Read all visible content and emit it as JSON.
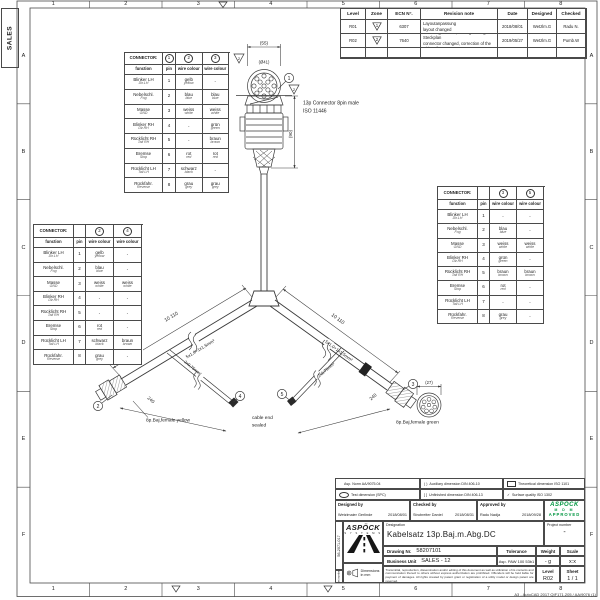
{
  "colors": {
    "line": "#3a3a3a",
    "approved_green": "#009640"
  },
  "frame": {
    "sales_stamp": "SALES",
    "top_zones": [
      "1",
      "2",
      "3",
      "4",
      "5",
      "6",
      "7",
      "8"
    ],
    "bottom_zones": [
      "1",
      "2",
      "3",
      "4",
      "5",
      "6",
      "7",
      "8"
    ],
    "left_zones": [
      "A",
      "B",
      "C",
      "D",
      "E",
      "F"
    ],
    "right_zones": [
      "A",
      "B",
      "C",
      "D",
      "E",
      "F"
    ],
    "corner_note": "A3 - AutoCAD 2017 QIF171.205 / AA/9076 (1)"
  },
  "revision_table": {
    "headers": {
      "level": "Level",
      "zone": "Zone",
      "ecn": "ECN N°.",
      "note": "Revision note",
      "date": "Date",
      "designed": "Designed",
      "checked": "Checked"
    },
    "rows": [
      {
        "level": "R01",
        "zone_flag": "1",
        "ecn": "6307",
        "note_de": "Layoutanpassung",
        "note_en": "layout changed",
        "date": "2018/08/01",
        "designed": "Wetzlm.G",
        "checked": "Radu N."
      },
      {
        "level": "R02",
        "zone_flag": "2",
        "ecn": "7640",
        "note_de": "Stecker geändert , Richtigstellung Steckplan",
        "note_en": "connector changed, correction of the wiring diagram",
        "date": "2019/05/27",
        "designed": "Wetzlm.G",
        "checked": "Pumb.W"
      }
    ]
  },
  "connector_tables": {
    "labels": {
      "title": "CONNECTOR:",
      "function": "function",
      "pin": "pin",
      "wire_colour": "wire colour"
    },
    "functions": [
      {
        "de": "Blinker LH",
        "en": "Dir.LH",
        "pin": "1"
      },
      {
        "de": "Nebelschl.",
        "en": "Fog",
        "pin": "2"
      },
      {
        "de": "Masse",
        "en": "GND",
        "pin": "3"
      },
      {
        "de": "Blinker RH",
        "en": "Dir.RH",
        "pin": "4"
      },
      {
        "de": "Rücklicht RH",
        "en": "Tail RH",
        "pin": "5"
      },
      {
        "de": "Bremse",
        "en": "Stop",
        "pin": "6"
      },
      {
        "de": "Rücklicht LH",
        "en": "Tail LH",
        "pin": "7"
      },
      {
        "de": "Rückfahr.",
        "en": "Reverse",
        "pin": "8"
      }
    ],
    "tables": [
      {
        "name": "connector-table-top-left",
        "pin_ref": "1",
        "refs": [
          "2",
          "3"
        ],
        "w1": [
          [
            "gelb",
            "yellow"
          ],
          [
            "blau",
            "blue"
          ],
          [
            "weiss",
            "white"
          ],
          null,
          null,
          [
            "rot",
            "red"
          ],
          [
            "schwarz",
            "black"
          ],
          [
            "grau",
            "grey"
          ]
        ],
        "w2": [
          null,
          [
            "blau",
            "blue"
          ],
          [
            "weiss",
            "white"
          ],
          [
            "grün",
            "green"
          ],
          [
            "braun",
            "brown"
          ],
          [
            "rot",
            "red"
          ],
          null,
          [
            "grau",
            "grey"
          ]
        ]
      },
      {
        "name": "connector-table-bottom-left",
        "pin_ref": "",
        "refs": [
          "2",
          "4"
        ],
        "w1": [
          [
            "gelb",
            "yellow"
          ],
          [
            "blau",
            "blue"
          ],
          [
            "weiss",
            "white"
          ],
          null,
          null,
          [
            "rot",
            "red"
          ],
          [
            "schwarz",
            "black"
          ],
          [
            "grau",
            "grey"
          ]
        ],
        "w2": [
          null,
          null,
          [
            "weiss",
            "white"
          ],
          null,
          null,
          null,
          [
            "braun",
            "brown"
          ],
          null
        ]
      },
      {
        "name": "connector-table-right",
        "pin_ref": "",
        "refs": [
          "3",
          "5"
        ],
        "w1": [
          null,
          [
            "blau",
            "blue"
          ],
          [
            "weiss",
            "white"
          ],
          [
            "grün",
            "green"
          ],
          [
            "braun",
            "brown"
          ],
          [
            "rot",
            "red"
          ],
          null,
          [
            "grau",
            "grey"
          ]
        ],
        "w2": [
          null,
          null,
          [
            "weiss",
            "white"
          ],
          null,
          [
            "braun",
            "brown"
          ],
          null,
          null,
          null
        ]
      }
    ]
  },
  "diagram": {
    "main_connector": {
      "line1": "13p Connector 8pin male",
      "line2": "ISO 11446"
    },
    "dims": {
      "width": "(55)",
      "diameter": "(Ø41)",
      "height": "(90)",
      "green_diameter": "(27)",
      "left_branch": "10 110",
      "right_branch": "10 110",
      "left_stub": "240",
      "right_stub": "240"
    },
    "specs": {
      "left": "5x1,0+1x1,5mm²",
      "right": "5x1,0+1x1,5mm²",
      "left_stub": "2x0,75mm²",
      "right_stub": "2x0,75mm²"
    },
    "labels": {
      "yellow_connector": "8p.Baj,female yellow",
      "green_connector": "8p.Baj,female green",
      "cable_end_line1": "cable end",
      "cable_end_line2": "sealed"
    },
    "balloons": [
      "1",
      "2",
      "3",
      "4",
      "5"
    ],
    "revision_flags": [
      "2",
      "2"
    ]
  },
  "title_block": {
    "legend": {
      "asp_norm": "Asp. Norm AA/9075.04",
      "aux_sym": "(  )",
      "aux": "Auxiliary dimension DIN 406-10",
      "theo": "Theoretical dimension ISO 1101",
      "test": "Test dimension (SPC)",
      "unfinished_sym": "[  ]",
      "unfinished": "Unfinished dimension DIN 406-13",
      "surface_sym": "✓",
      "surface": "Surface quality ISO 1302"
    },
    "sign": {
      "designed_label": "Designed by",
      "designed_name": "Wetzlmaier Gerlinde",
      "designed_date": "2018/08/01",
      "checked_label": "Checked by",
      "checked_name": "Strubreiter Daniel",
      "checked_date": "2018/08/31",
      "approved_label": "Approved by",
      "approved_name": "Radu Nadja",
      "approved_date": "2018/09/28"
    },
    "stamp": {
      "brand": "ASPÖCK",
      "line1": "M D M",
      "line2": "APPROVED",
      "project_label": "Project number",
      "project_value": "-"
    },
    "logo": {
      "brand": "ASPÖCK",
      "sub": "S Y S T E M S"
    },
    "designation_label": "Designation",
    "designation": "Kabelsatz 13p.Baj.m.Abg.DC",
    "drawing_label": "Drawing Nr.",
    "drawing_value": "58207101",
    "bu_label": "Business Unit",
    "bu_value": "SALES - 12",
    "tolerance_label": "Tolerance",
    "tolerance_value": "Asp. PAW 100 53b1",
    "weight_label": "Weight",
    "weight_value": "- g",
    "scale_label": "Scale",
    "scale_value": "x:x",
    "level_label": "Level",
    "level_value": "R02",
    "sheet_label": "Sheet",
    "sheet_value": "1 / 1",
    "dims_note": "Dimensions in mm",
    "part_number": "56-2071-017",
    "part_number_label": "Part number",
    "disclaimer": "Transmittal, reproduction, dissemination and/or editing of this document as well as utilization of its contents and communication thereof to others without express authorization are prohibited. Offenders will be held liable for payment of damages. All rights created by patent grant or registration of a utility model or design patent are reserved."
  }
}
